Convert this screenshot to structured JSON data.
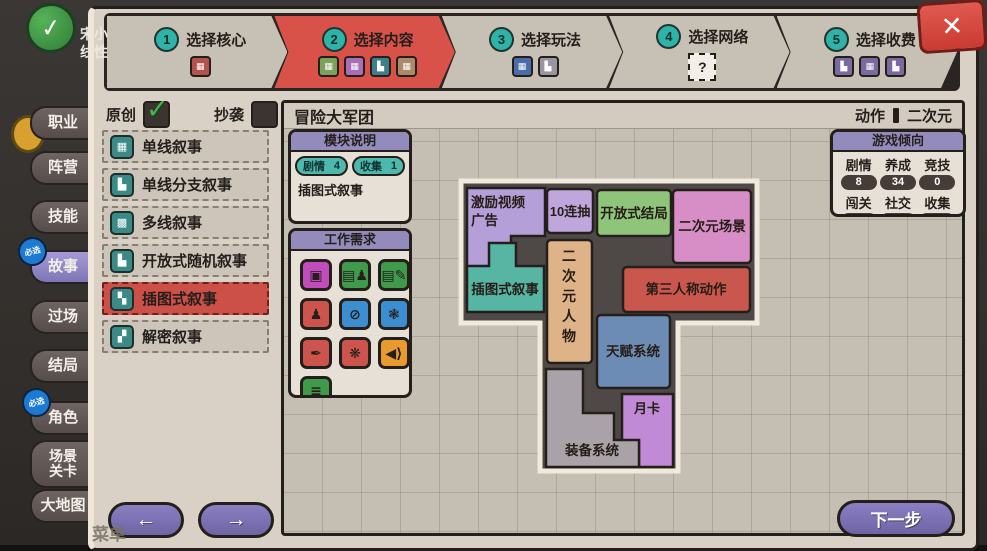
{
  "colors": {
    "active_step": "#d8524a",
    "accent_purple": "#7f76b6",
    "board_bg": "#4e4947"
  },
  "stepper": {
    "steps": [
      {
        "num": "1",
        "label": "选择核心",
        "active": false,
        "icons": [
          {
            "name": "core-module-icon",
            "color": "#b5524e",
            "glyph": "▦"
          }
        ]
      },
      {
        "num": "2",
        "label": "选择内容",
        "active": true,
        "icons": [
          {
            "name": "content-module-icon-green",
            "color": "#7da05c",
            "glyph": "▦"
          },
          {
            "name": "content-module-icon-purple",
            "color": "#a86fb4",
            "glyph": "▦"
          },
          {
            "name": "content-module-icon-teal",
            "color": "#3e7f8a",
            "glyph": "▙"
          },
          {
            "name": "content-module-icon-tan",
            "color": "#a98a6a",
            "glyph": "▦"
          }
        ]
      },
      {
        "num": "3",
        "label": "选择玩法",
        "active": false,
        "icons": [
          {
            "name": "play-module-icon-blue",
            "color": "#4a6da8",
            "glyph": "▦"
          },
          {
            "name": "play-module-icon-gray",
            "color": "#9a95a0",
            "glyph": "▙"
          }
        ]
      },
      {
        "num": "4",
        "label": "选择网络",
        "active": false,
        "unknown": "?",
        "icons": []
      },
      {
        "num": "5",
        "label": "选择收费",
        "active": false,
        "icons": [
          {
            "name": "pay-module-icon-1",
            "color": "#7a6aa0",
            "glyph": "▙"
          },
          {
            "name": "pay-module-icon-2",
            "color": "#7a6aa0",
            "glyph": "▦"
          },
          {
            "name": "pay-module-icon-3",
            "color": "#7a6aa0",
            "glyph": "▙"
          }
        ]
      }
    ],
    "close_glyph": "✕"
  },
  "sidebar": {
    "player_name": "宋小\n线性",
    "check_glyph": "✓",
    "menu_label": "菜单",
    "required_badge": "必选",
    "tabs": [
      {
        "label": "职业",
        "selected": false,
        "badge": false,
        "top": 106,
        "tall": false
      },
      {
        "label": "阵营",
        "selected": false,
        "badge": false,
        "top": 151,
        "tall": false
      },
      {
        "label": "技能",
        "selected": false,
        "badge": false,
        "top": 200,
        "tall": false
      },
      {
        "label": "故事",
        "selected": true,
        "badge": true,
        "top": 250,
        "tall": false
      },
      {
        "label": "过场",
        "selected": false,
        "badge": false,
        "top": 300,
        "tall": false
      },
      {
        "label": "结局",
        "selected": false,
        "badge": false,
        "top": 349,
        "tall": false
      },
      {
        "label": "角色",
        "selected": false,
        "badge": true,
        "top": 401,
        "tall": false
      },
      {
        "label": "场景\n关卡",
        "selected": false,
        "badge": false,
        "top": 440,
        "tall": true
      },
      {
        "label": "大地图",
        "selected": false,
        "badge": false,
        "top": 489,
        "tall": false
      }
    ]
  },
  "header": {
    "original_label": "原创",
    "original_checked": true,
    "copy_label": "抄袭",
    "copy_checked": false,
    "title": "冒险大军团",
    "genre": "动作",
    "style": "二次元"
  },
  "story_list": {
    "items": [
      {
        "label": "单线叙事",
        "icon_name": "single-line-icon",
        "glyph": "▦",
        "selected": false
      },
      {
        "label": "单线分支叙事",
        "icon_name": "branch-line-icon",
        "glyph": "▙",
        "selected": false
      },
      {
        "label": "多线叙事",
        "icon_name": "multi-line-icon",
        "glyph": "▩",
        "selected": false
      },
      {
        "label": "开放式随机叙事",
        "icon_name": "open-random-icon",
        "glyph": "▙",
        "selected": false
      },
      {
        "label": "插图式叙事",
        "icon_name": "illustrated-icon",
        "glyph": "▚",
        "selected": true
      },
      {
        "label": "解密叙事",
        "icon_name": "puzzle-narrative-icon",
        "glyph": "▞",
        "selected": false
      }
    ]
  },
  "module_info": {
    "title": "模块说明",
    "stats": [
      {
        "label": "剧情",
        "value": "4"
      },
      {
        "label": "收集",
        "value": "1"
      }
    ],
    "description": "插图式叙事"
  },
  "work_needs": {
    "title": "工作需求",
    "icons": [
      {
        "name": "cpu-icon",
        "color": "#c24bbd",
        "glyph": "▣"
      },
      {
        "name": "clipboard-person-icon",
        "color": "#3f9a4c",
        "glyph": "▤♟"
      },
      {
        "name": "clipboard-pencil-icon",
        "color": "#3f9a4c",
        "glyph": "▤✎"
      },
      {
        "name": "person-icon",
        "color": "#cd544d",
        "glyph": "♟"
      },
      {
        "name": "prohibit-icon",
        "color": "#3d8ed0",
        "glyph": "⊘"
      },
      {
        "name": "brain-icon",
        "color": "#3d8ed0",
        "glyph": "❃"
      },
      {
        "name": "seal-pen-icon",
        "color": "#cd544d",
        "glyph": "✒"
      },
      {
        "name": "splash-icon",
        "color": "#cd544d",
        "glyph": "❋"
      },
      {
        "name": "speaker-icon",
        "color": "#e89a2e",
        "glyph": "◀⟩"
      },
      {
        "name": "book-icon",
        "color": "#3f9a4c",
        "glyph": "≣"
      }
    ]
  },
  "tendency": {
    "title": "游戏倾向",
    "stats": [
      {
        "label": "剧情",
        "value": "8"
      },
      {
        "label": "养成",
        "value": "34"
      },
      {
        "label": "竞技",
        "value": "0"
      },
      {
        "label": "闯关",
        "value": "15"
      },
      {
        "label": "社交",
        "value": "0"
      },
      {
        "label": "收集",
        "value": "3"
      }
    ]
  },
  "board": {
    "pieces": [
      {
        "id": "reward-video-ads",
        "label": "激励视频\n广告",
        "color": "#b49fd8"
      },
      {
        "id": "ten-pull",
        "label": "10连抽",
        "color": "#bfa7de"
      },
      {
        "id": "open-ending",
        "label": "开放式结局",
        "color": "#8fc57b"
      },
      {
        "id": "anime-scene",
        "label": "二次元场景",
        "color": "#d78ec7"
      },
      {
        "id": "illustrated-narrative",
        "label": "插图式叙事",
        "color": "#57b5a4"
      },
      {
        "id": "anime-character",
        "label": "二次元人物",
        "color": "#deb388",
        "vertical": true
      },
      {
        "id": "third-person-action",
        "label": "第三人称动作",
        "color": "#c9574d"
      },
      {
        "id": "talent-system",
        "label": "天赋系统",
        "color": "#6d8cb5"
      },
      {
        "id": "monthly-card",
        "label": "月卡",
        "color": "#c08ad6"
      },
      {
        "id": "equipment-system",
        "label": "装备系统",
        "color": "#a9a2a9"
      }
    ]
  },
  "footer": {
    "prev_glyph": "←",
    "next_glyph": "→",
    "next_label": "下一步"
  }
}
